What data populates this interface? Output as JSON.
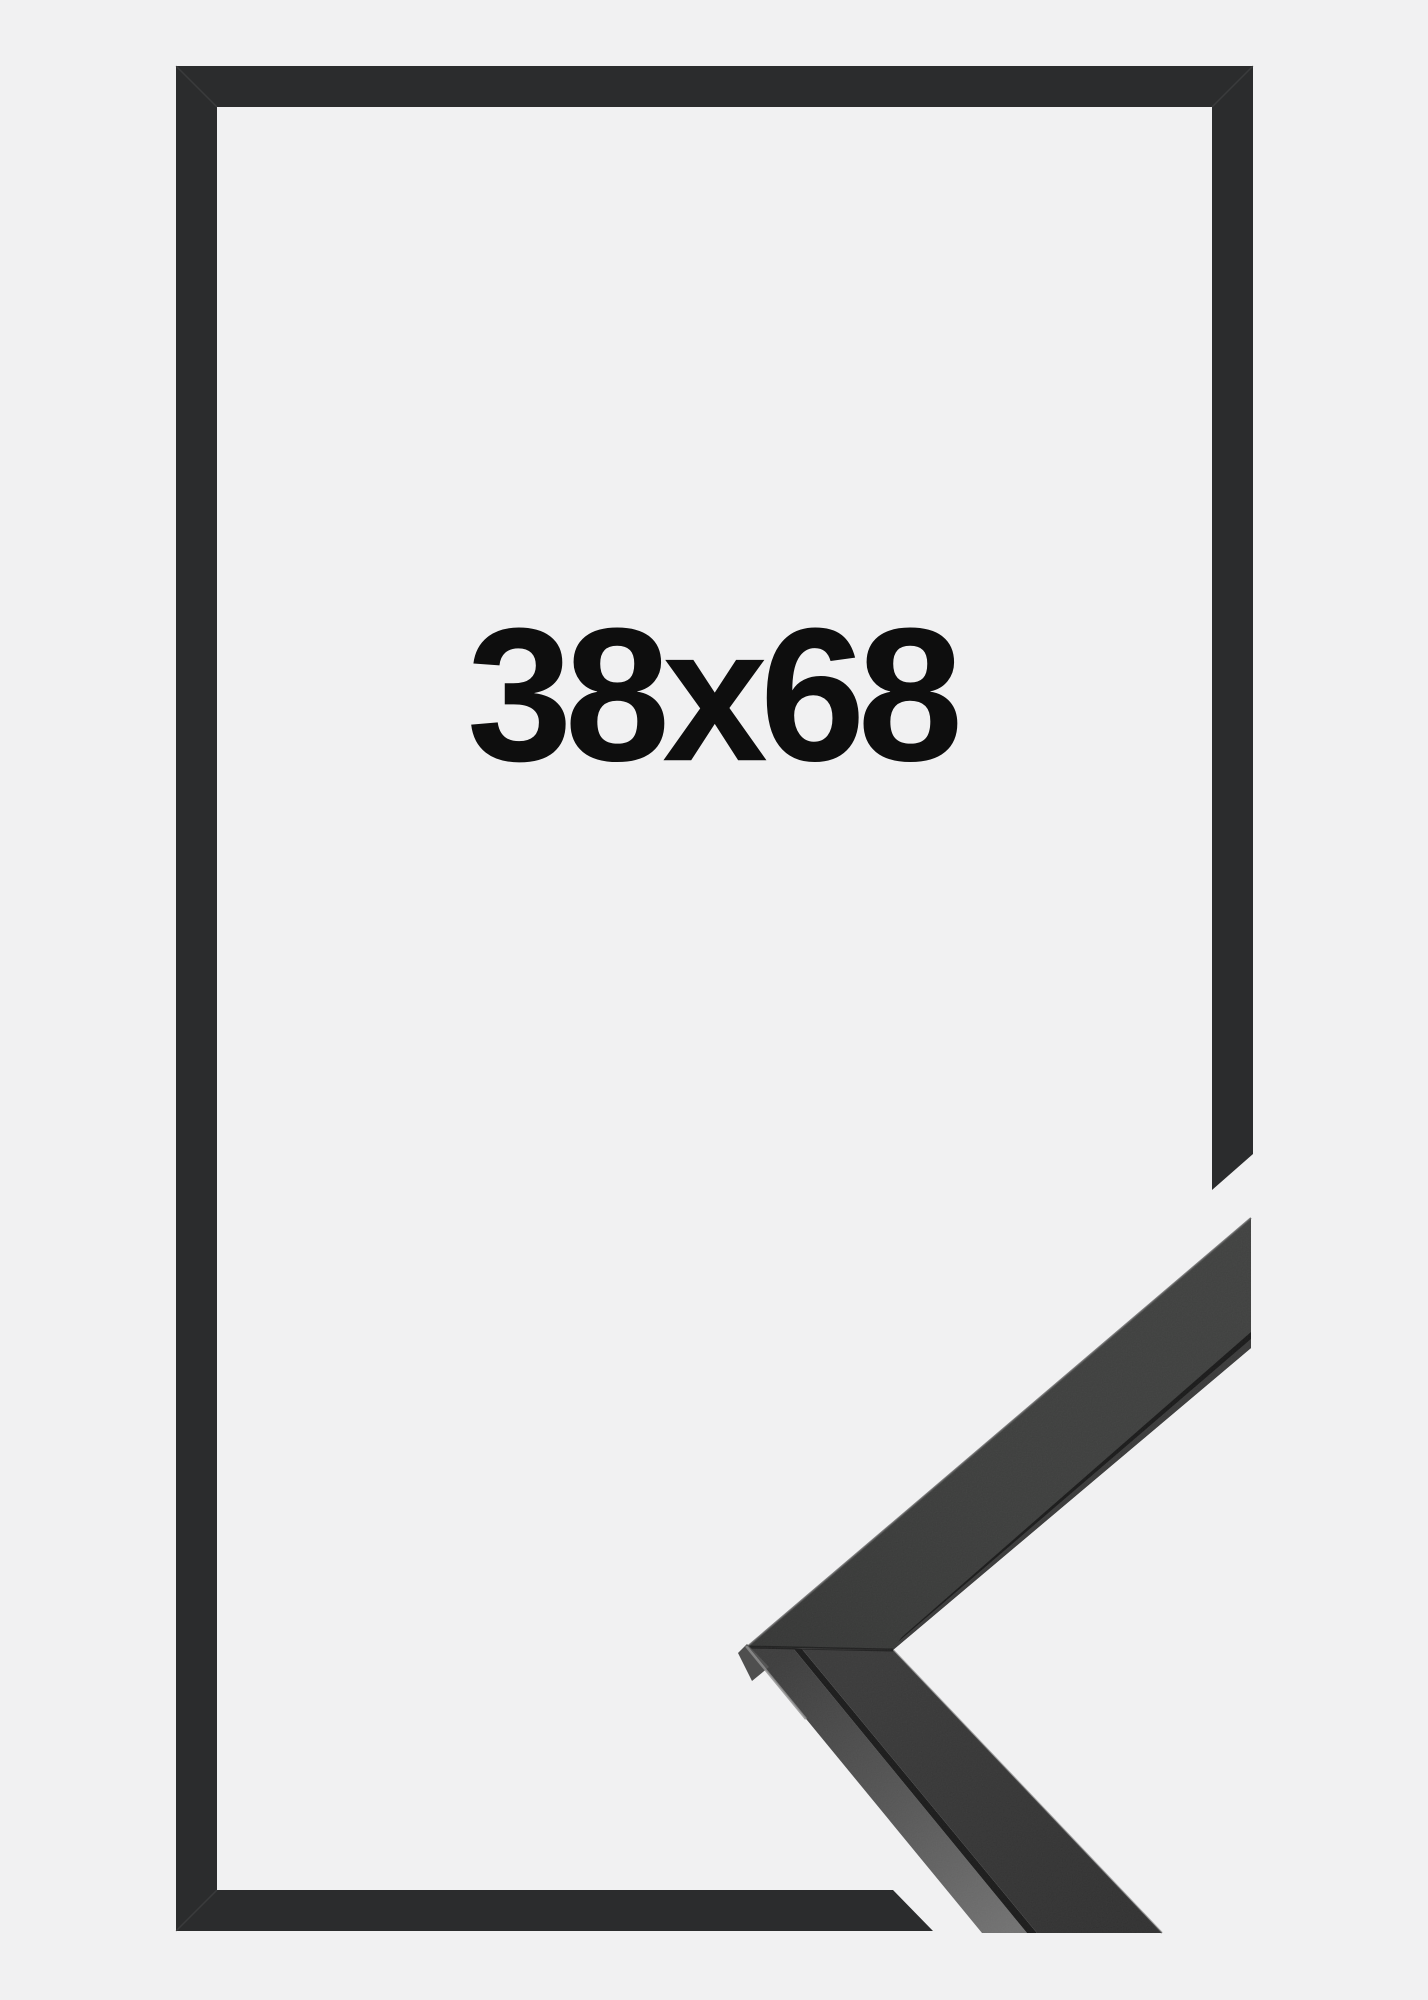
{
  "product_image": {
    "size_label": "38x68",
    "colors": {
      "background": "#f1f1f2",
      "frame_outline": "#2b2c2d",
      "text": "#0e0e0e",
      "corner_face": "#3a3b3a",
      "corner_face_dark": "#2e2e2e",
      "corner_top_light": "#6f6f6f"
    }
  }
}
